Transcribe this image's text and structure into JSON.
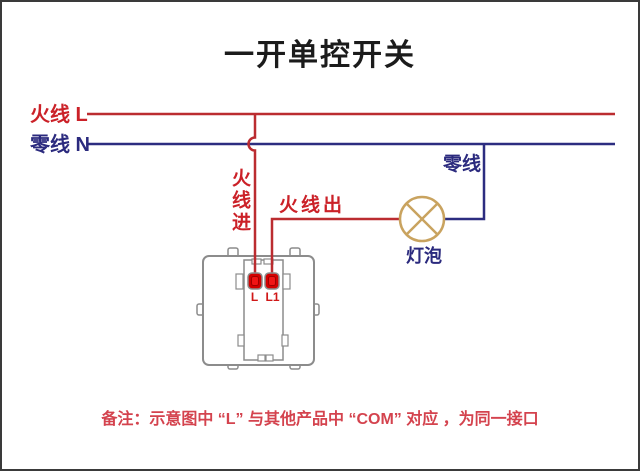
{
  "title": "一开单控开关",
  "diagram": {
    "live_bus_label": "火线 L",
    "neutral_bus_label": "零线 N",
    "live_in_label": "火线进",
    "live_out_label": "火线出",
    "neutral_branch_label": "零线",
    "bulb_label": "灯泡",
    "switch_terminals": [
      {
        "label": "L"
      },
      {
        "label": "L1"
      }
    ],
    "note": "备注：示意图中 “L” 与其他产品中 “COM” 对应 ，为同一接口"
  },
  "colors": {
    "live_wire": "#bb2c30",
    "neutral_wire": "#2c2d80",
    "live_text": "#cb2128",
    "neutral_text": "#2b2a7e",
    "lamp_outline": "#c9a35f",
    "terminal_fill": "#d40000",
    "terminal_core": "#f01515",
    "switch_outline": "#8c8c8c",
    "note_text": "#d4434e",
    "title_text": "#1b1b1b"
  }
}
